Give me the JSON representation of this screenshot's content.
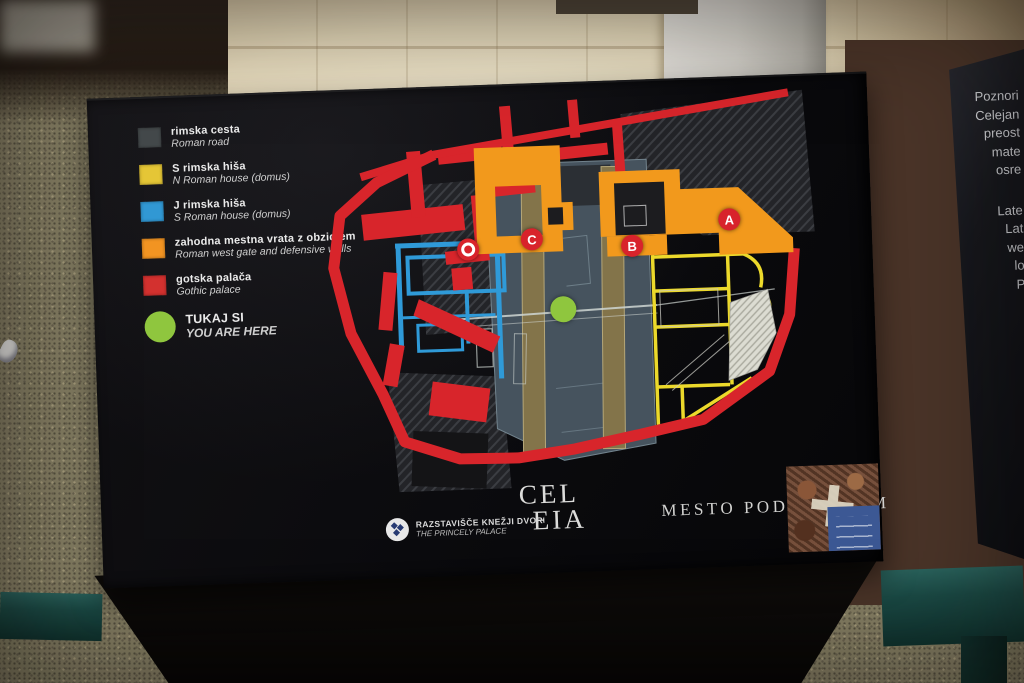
{
  "legend": {
    "items": [
      {
        "label_sl": "rimska cesta",
        "label_en": "Roman road",
        "color": "#44494b"
      },
      {
        "label_sl": "S rimska hiša",
        "label_en": "N Roman house (domus)",
        "color": "#e5c636"
      },
      {
        "label_sl": "J rimska hiša",
        "label_en": "S Roman house (domus)",
        "color": "#3198d4"
      },
      {
        "label_sl": "zahodna mestna vrata z obzidjem",
        "label_en": "Roman west gate and defensive walls",
        "color": "#f29422"
      },
      {
        "label_sl": "gotska palača",
        "label_en": "Gothic palace",
        "color": "#d3312f"
      }
    ],
    "you_are_here": {
      "label_sl": "TUKAJ SI",
      "label_en": "YOU ARE HERE",
      "color": "#8fc63e"
    }
  },
  "map": {
    "markers": [
      {
        "label": "A"
      },
      {
        "label": "B"
      },
      {
        "label": "C"
      }
    ],
    "marker_color": "#d8232b",
    "wall_color": "#d8252b",
    "west_gate_color": "#f2991c",
    "palace_footprint_color": "#46535e"
  },
  "title": {
    "word_part1": "CEL",
    "word_part2": "EIA",
    "subtitle": "MESTO POD MESTOM"
  },
  "exhibition": {
    "name_sl": "RAZSTAVIŠČE KNEŽJI DVOR",
    "name_en": "THE PRINCELY PALACE"
  },
  "side_panel": {
    "text_fragments": [
      "Poznori",
      "Celejan",
      "preost",
      "mate",
      "osre",
      "Late",
      "Lat",
      "we",
      "lo",
      "P"
    ]
  }
}
